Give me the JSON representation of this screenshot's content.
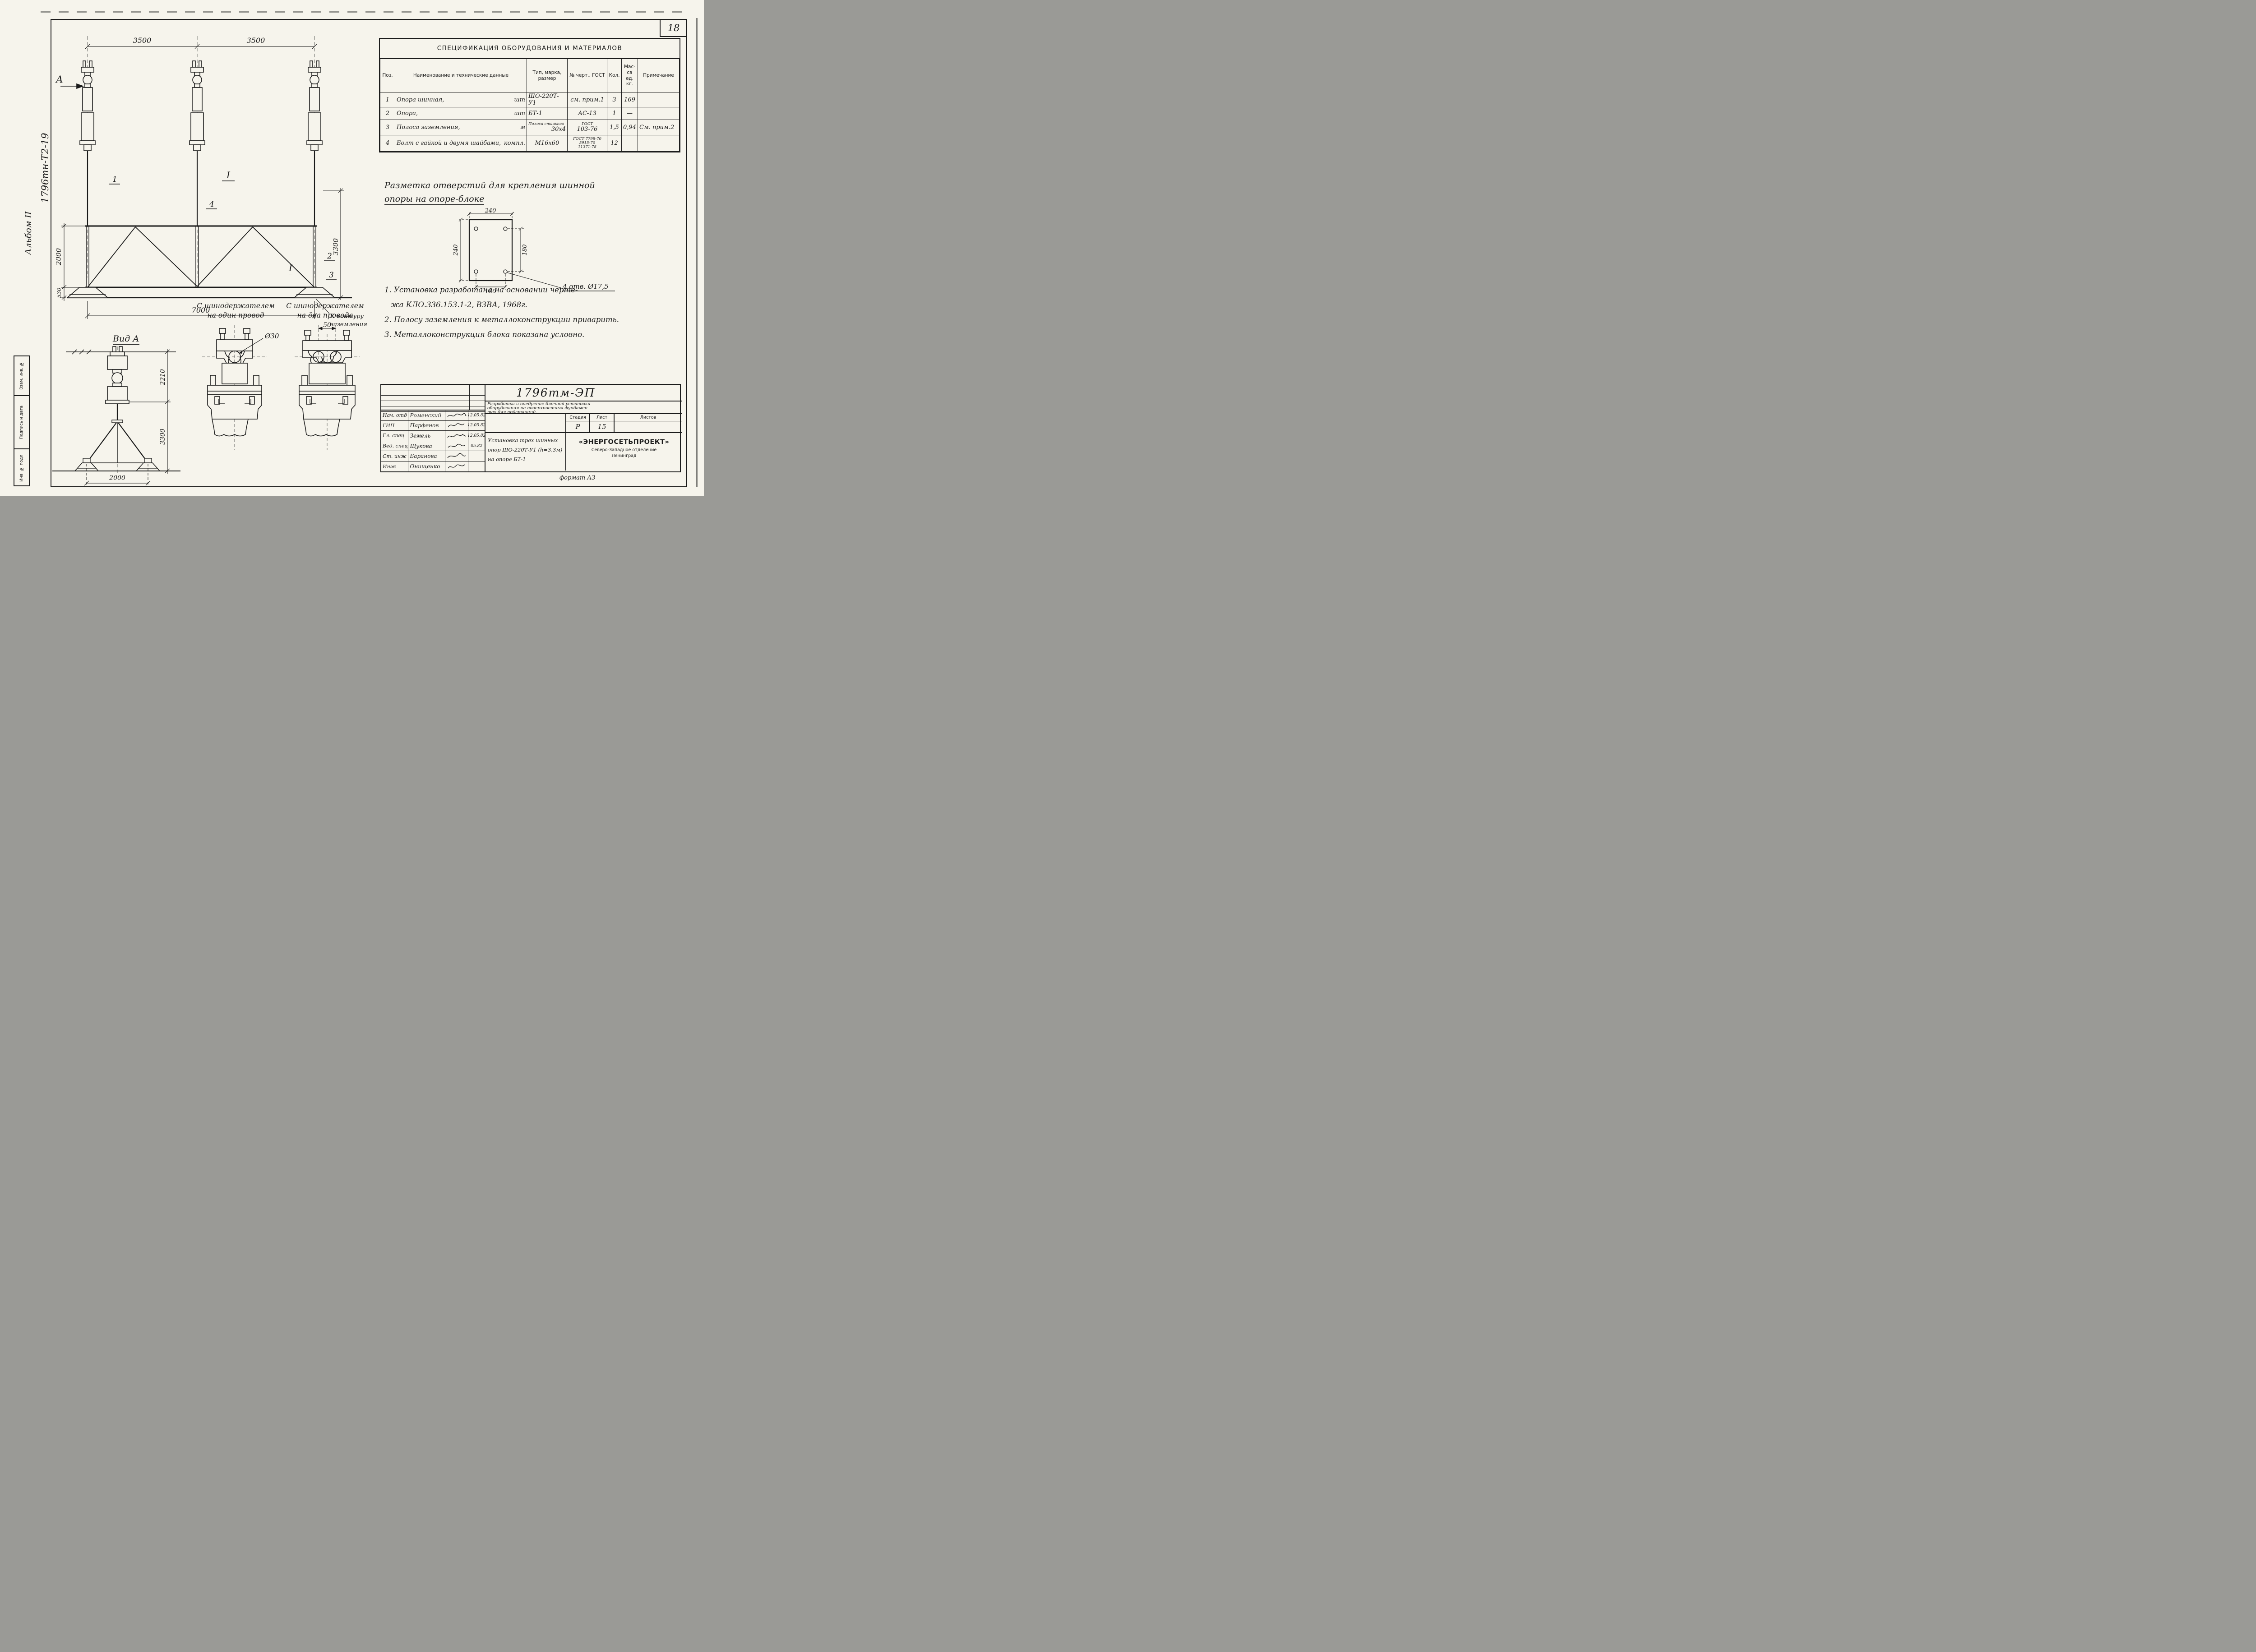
{
  "sheet": {
    "page_number": "18",
    "format_note": "формат А3",
    "margin_code": "1796тн-Т2-19",
    "margin_album": "Альбом II",
    "stamps": {
      "s1": "Взам. инв. №",
      "s2": "Подпись и дата",
      "s3": "Инв. № подл."
    }
  },
  "spec": {
    "title": "СПЕЦИФИКАЦИЯ ОБОРУДОВАНИЯ И МАТЕРИАЛОВ",
    "h_pos": "Поз.",
    "h_name": "Наименование и технические данные",
    "h_type": "Тип, марка, размер",
    "h_gost": "№ черт., ГОСТ",
    "h_qty": "Кол.",
    "h_mass": "Мас-са ед. кг.",
    "h_note": "Примечание",
    "rows": [
      {
        "pos": "1",
        "name": "Опора шинная,",
        "unit": "шт",
        "t1": "",
        "t2": "ШО-220Т-У1",
        "g1": "см. прим.1",
        "g2": "",
        "g3": "",
        "qty": "3",
        "mass": "169",
        "note": ""
      },
      {
        "pos": "2",
        "name": "Опора,",
        "unit": "шт",
        "t1": "",
        "t2": "БТ-1",
        "g1": "АС-13",
        "g2": "",
        "g3": "",
        "qty": "1",
        "mass": "—",
        "note": ""
      },
      {
        "pos": "3",
        "name": "Полоса заземления,",
        "unit": "м",
        "t1": "Полоса стальная",
        "t2": "30х4",
        "g1": "ГОСТ",
        "g2": "103-76",
        "g3": "",
        "qty": "1,5",
        "mass": "0,94",
        "note": "См. прим.2"
      },
      {
        "pos": "4",
        "name": "Болт с гайкой и двумя шайбами,",
        "unit": "компл.",
        "t1": "",
        "t2": "М16х60",
        "g1": "ГОСТ 7798-70",
        "g2": "5915-70",
        "g3": "11371-78",
        "qty": "12",
        "mass": "",
        "note": ""
      }
    ]
  },
  "front_view": {
    "dim_span_left": "3500",
    "dim_span_right": "3500",
    "dim_height": "2000",
    "dim_base": "530",
    "dim_right": "3300",
    "dim_total": "7000",
    "view_arrow": "А",
    "section_mark": "I",
    "pos1": "1",
    "pos2": "2",
    "pos3": "3",
    "pos4": "4",
    "ground_note_1": "К контуру",
    "ground_note_2": "заземления"
  },
  "view_a": {
    "title": "Вид А",
    "dim_insulator": "2210",
    "dim_stand": "3300",
    "dim_base": "2000"
  },
  "details": {
    "section_mark": "I",
    "cap1_line1": "С шинодержателем",
    "cap1_line2": "на один провод",
    "cap2_line1": "С шинодержателем",
    "cap2_line2": "на два провода",
    "dia": "Ø30",
    "spacing": "50"
  },
  "holes": {
    "head1": "Разметка отверстий для крепления шинной",
    "head2": "опоры на опоре-блоке",
    "dim_top": "240",
    "dim_left": "240",
    "dim_right": "180",
    "dim_bottom": "180",
    "note": "4 отв. Ø17,5"
  },
  "notes": {
    "n1": "1. Установка разработана на основании черте-",
    "n1b": "жа  КЛО.336.153.1-2, ВЗВА, 1968г.",
    "n2": "2. Полосу заземления к металлоконструкции приварить.",
    "n3": "3. Металлоконструкция блока показана условно."
  },
  "tb": {
    "doc": "1796тм-ЭП",
    "p1": "Разработка и внедрение блочной установки",
    "p2": "оборудования на поверхностных фундамен-",
    "p3": "тах для подстанций.",
    "stage_l": "Стадия",
    "sheet_l": "Лист",
    "sheets_l": "Листов",
    "stage": "Р",
    "sheet": "15",
    "sheets": "",
    "t1": "Установка трех шинных",
    "t2": "опор ШО-220Т-У1 (h=3,3м)",
    "t3": "на опоре БТ-1",
    "org": "«ЭНЕРГОСЕТЬПРОЕКТ»",
    "org2": "Северо-Западное отделение",
    "org3": "Ленинград",
    "rows": [
      {
        "role": "Нач. отд",
        "name": "Роменский",
        "date": "12.05.82"
      },
      {
        "role": "ГИП",
        "name": "Парфенов",
        "date": "12.05.82"
      },
      {
        "role": "Гл. спец",
        "name": "Земель",
        "date": "12.05.82"
      },
      {
        "role": "Вед. спец",
        "name": "Щукова",
        "date": "05.82"
      },
      {
        "role": "Ст. инж",
        "name": "Баранова",
        "date": ""
      },
      {
        "role": "Инж",
        "name": "Онищенко",
        "date": ""
      }
    ]
  }
}
